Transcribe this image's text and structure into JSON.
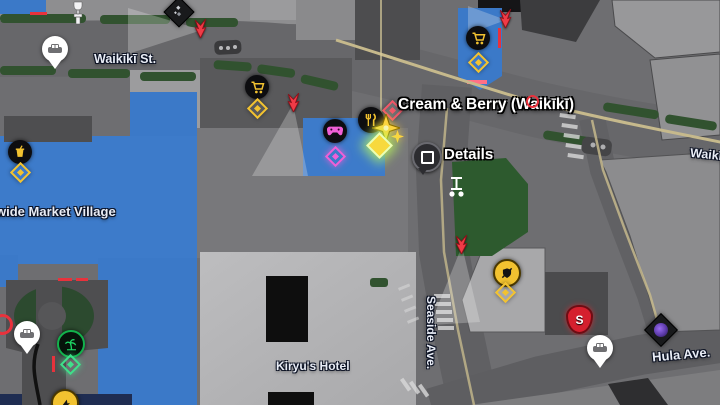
{
  "map_labels": {
    "waikiki_st": "Waikīkī St.",
    "waikiki_st_east": "Waikīkī",
    "seaside_ave": "Seaside Ave.",
    "hula_ave": "Hula Ave.",
    "market_village": "wide Market Village",
    "kiryus_hotel": "Kiryu's Hotel"
  },
  "selection": {
    "tooltip_title": "Cream & Berry (Waikīkī)",
    "action_button": "square-button",
    "action_label": "Details"
  },
  "markers": {
    "shield_letter": "S",
    "poi_icons": [
      "restaurant-icon",
      "shopping-cart-icon",
      "game-controller-icon",
      "drink-icon",
      "palm-tree-icon",
      "weapon-shop-icon",
      "taxi-pin-icon",
      "car-pin-icon",
      "segway-icon",
      "trophy-icon",
      "photo-diamond-icon",
      "sujimon-diamond-icon",
      "enemy-arrow-icon",
      "destination-star-cursor",
      "collectible-diamond-icon"
    ]
  },
  "colors": {
    "building_blue": "#3b79c8",
    "road_gray": "#666669",
    "plaza_gray": "#78787b",
    "hotel_gray": "#b5b5b7",
    "hedge_green": "#31522f",
    "park_green": "#2d5a2e",
    "route_tan": "#c6b98c",
    "marker_yellow": "#f2c230",
    "marker_pink": "#f05fd6",
    "enemy_red": "#e8323c",
    "cursor_gold": "#ffd23e",
    "navy_strip": "#1f2d52"
  }
}
